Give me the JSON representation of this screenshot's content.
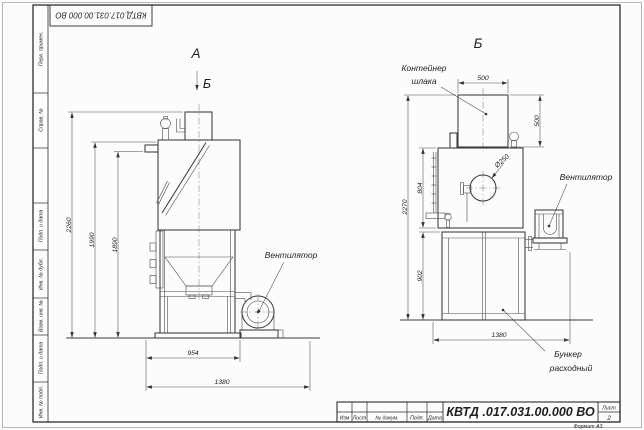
{
  "sheet": {
    "stamp_top": "КВТД.017.031.00.000  ВО",
    "margin_labels": [
      "Перв. примен.",
      "Справ. №",
      "Подп. и дата",
      "Инв. № дубл.",
      "Взам. инв. №",
      "Подп. и дата",
      "Инв. № подл."
    ],
    "title_block": {
      "revision_columns": [
        "Изм",
        "Лист",
        "№ докум.",
        "Подп.",
        "Дата"
      ],
      "designation": "КВТД .017.031.00.000  ВО",
      "sheet_label": "Лист",
      "sheet_number": "2",
      "format": "Формат А3"
    }
  },
  "views": {
    "front": {
      "label": "А",
      "direction_label": "Б"
    },
    "side": {
      "label": "Б"
    }
  },
  "callouts": {
    "fan": "Вентилятор",
    "slag_container_line1": "Контейнер",
    "slag_container_line2": "шлака",
    "hopper_line1": "Бункер",
    "hopper_line2": "расходный"
  },
  "dims": {
    "front": {
      "total_height": "2260",
      "body_height": "1990",
      "inlet_height": "1890",
      "body_width": "954",
      "overall_width": "1380"
    },
    "side": {
      "container_width": "500",
      "container_height": "500",
      "hole_dia": "Ø250",
      "upper_height": "804",
      "total_height": "2270",
      "hopper_height": "902",
      "overall_width": "1380"
    }
  }
}
